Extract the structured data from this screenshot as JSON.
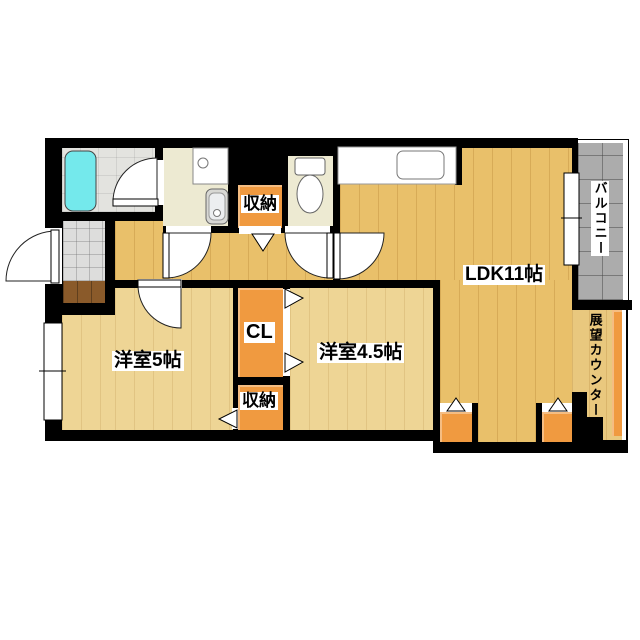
{
  "floorplan": {
    "rooms": {
      "ldk": {
        "label": "LDK11帖"
      },
      "bedroom5": {
        "label": "洋室5帖"
      },
      "bedroom45": {
        "label": "洋室4.5帖"
      },
      "closet": {
        "label": "CL"
      },
      "storage_top": {
        "label": "収納"
      },
      "storage_bottom": {
        "label": "収納"
      },
      "balcony": {
        "label": "バルコニー"
      },
      "view_counter": {
        "label": "展望カウンター"
      }
    },
    "colors": {
      "wall": "#000000",
      "wood_gold": "#e9c06a",
      "wood_pale": "#eed595",
      "service_cream": "#edead2",
      "storage_orange": "#f09a40",
      "bathtub_cyan": "#74e9ec",
      "balcony_gray": "#acacac",
      "genkan_brown": "#8a5a2a",
      "bath_tile": "#e3e3df",
      "entrance_tile": "#dddddc"
    }
  }
}
